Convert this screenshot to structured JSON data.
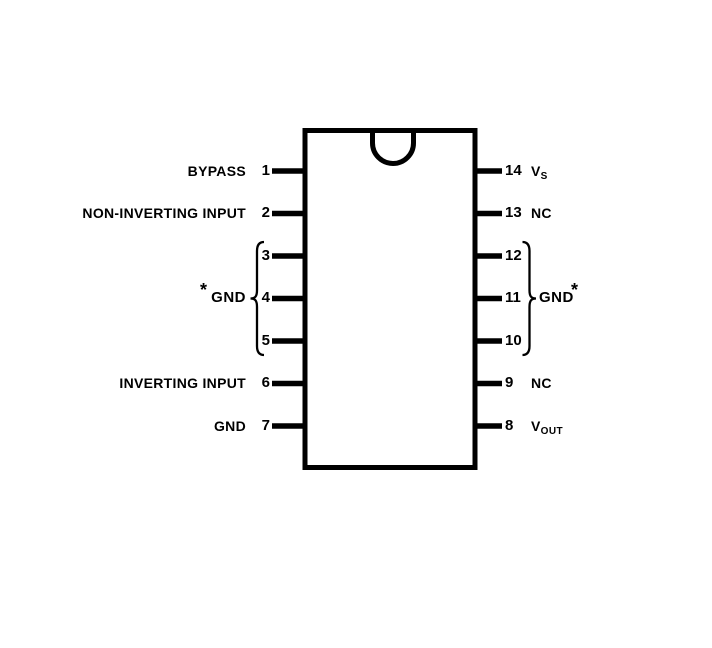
{
  "diagram": {
    "left_pins": [
      {
        "number": "1",
        "label": "BYPASS"
      },
      {
        "number": "2",
        "label": "NON-INVERTING INPUT"
      },
      {
        "number": "3",
        "label": ""
      },
      {
        "number": "4",
        "label": ""
      },
      {
        "number": "5",
        "label": ""
      },
      {
        "number": "6",
        "label": "INVERTING INPUT"
      },
      {
        "number": "7",
        "label": "GND"
      }
    ],
    "right_pins": [
      {
        "number": "14",
        "label": "V",
        "sub": "S"
      },
      {
        "number": "13",
        "label": "NC",
        "sub": ""
      },
      {
        "number": "12",
        "label": "",
        "sub": ""
      },
      {
        "number": "11",
        "label": "",
        "sub": ""
      },
      {
        "number": "10",
        "label": "",
        "sub": ""
      },
      {
        "number": "9",
        "label": "NC",
        "sub": ""
      },
      {
        "number": "8",
        "label": "V",
        "sub": "OUT"
      }
    ],
    "left_group": {
      "asterisk": "*",
      "label": "GND"
    },
    "right_group": {
      "label": "GND",
      "asterisk": "*"
    },
    "colors": {
      "line": "#000000",
      "background": "#ffffff"
    }
  }
}
